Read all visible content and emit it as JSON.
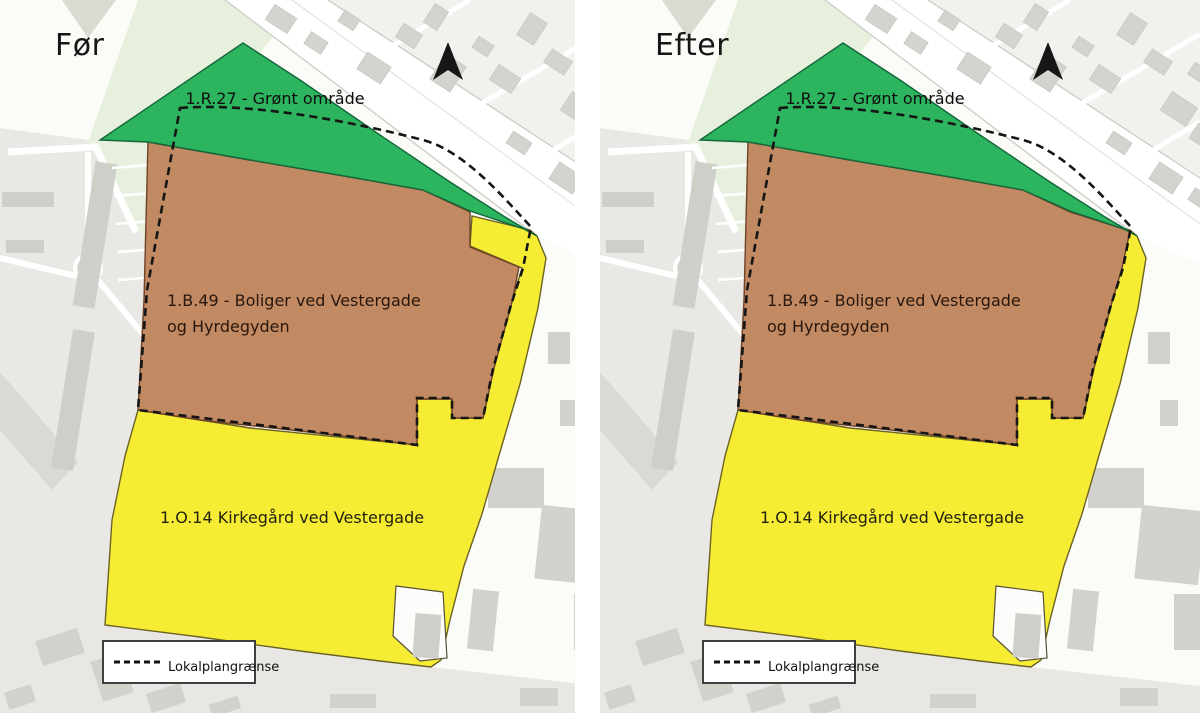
{
  "panels": {
    "before": {
      "title": "Før"
    },
    "after": {
      "title": "Efter"
    }
  },
  "legend": {
    "label": "Lokalplangrænse"
  },
  "zones": {
    "green": {
      "code": "1.R.27",
      "label": "1.R.27 - Grønt område",
      "color": "#2db45e"
    },
    "brown": {
      "code": "1.B.49",
      "label_line1": "1.B.49 - Boliger ved Vestergade",
      "label_line2": "og Hyrdegyden",
      "color": "#c18a62"
    },
    "yellow": {
      "code": "1.O.14",
      "label": "1.O.14 Kirkegård ved Vestergade",
      "color": "#f6ec33"
    }
  },
  "map_change": {
    "before_note": "yellow cemetery notch at NE corner of housing zone",
    "after_note": "housing zone extended to plan boundary at NE corner"
  },
  "geometry": {
    "base": [
      {
        "k": "polys",
        "f": "#fbfbf8",
        "name": "map-background",
        "items": [
          [
            [
              0,
              0
            ],
            [
              600,
              0
            ],
            [
              600,
              713
            ],
            [
              0,
              713
            ]
          ]
        ]
      },
      {
        "k": "polys",
        "f": "#f2f1ed",
        "name": "block-northeast",
        "items": [
          [
            [
              318,
              0
            ],
            [
              600,
              0
            ],
            [
              600,
              176
            ]
          ]
        ]
      },
      {
        "k": "polys",
        "f": "#e7f0dc",
        "name": "park-area",
        "items": [
          [
            [
              138,
              0
            ],
            [
              304,
              0
            ],
            [
              252,
              62
            ],
            [
              196,
              338
            ],
            [
              150,
              345
            ],
            [
              88,
              142
            ]
          ]
        ]
      },
      {
        "k": "polys",
        "f": "#d9dbd1",
        "name": "wooded-triangle",
        "items": [
          [
            [
              62,
              0
            ],
            [
              116,
              0
            ],
            [
              88,
              38
            ]
          ]
        ]
      },
      {
        "k": "polys",
        "f": "#eae8e4",
        "name": "residential-area-west",
        "items": [
          [
            [
              0,
              128
            ],
            [
              88,
              140
            ],
            [
              150,
              250
            ],
            [
              196,
              340
            ],
            [
              186,
              500
            ],
            [
              182,
              713
            ],
            [
              0,
              713
            ]
          ]
        ]
      },
      {
        "k": "polys",
        "f": "#dbd9d4",
        "name": "road-band-southwest",
        "items": [
          [
            [
              0,
              372
            ],
            [
              78,
              462
            ],
            [
              52,
              490
            ],
            [
              0,
              430
            ]
          ]
        ]
      },
      {
        "k": "polys",
        "f": "#e9e7e3",
        "name": "area-south",
        "items": [
          [
            [
              0,
              598
            ],
            [
              105,
              622
            ],
            [
              300,
              652
            ],
            [
              440,
              668
            ],
            [
              600,
              686
            ],
            [
              600,
              713
            ],
            [
              0,
              713
            ]
          ]
        ]
      },
      {
        "k": "polys",
        "f": "#ffffff",
        "name": "road-vestergade",
        "items": [
          [
            [
              225,
              0
            ],
            [
              328,
              0
            ],
            [
              600,
              178
            ],
            [
              600,
              264
            ],
            [
              537,
              236
            ]
          ]
        ]
      },
      {
        "k": "lines",
        "s": "#ccccc5",
        "sw": 1.3,
        "name": "road-edge",
        "items": [
          [
            328,
            0,
            600,
            178
          ],
          [
            225,
            0,
            537,
            236
          ]
        ]
      },
      {
        "k": "lines",
        "s": "#dedcd6",
        "sw": 1,
        "name": "road-centerline",
        "items": [
          [
            292,
            0,
            600,
            224
          ]
        ]
      },
      {
        "k": "lines",
        "s": "#ffffff",
        "sw": 5,
        "name": "side-street",
        "items": [
          [
            392,
            46,
            470,
            0
          ],
          [
            474,
            108,
            600,
            34
          ],
          [
            540,
            158,
            600,
            122
          ]
        ]
      },
      {
        "k": "rects",
        "f": "#d4d4cf",
        "s": "#c8c8c2",
        "sw": 0.8,
        "rot": 33,
        "name": "building",
        "items": [
          [
            268,
            10,
            26,
            18
          ],
          [
            306,
            36,
            20,
            14
          ],
          [
            340,
            14,
            18,
            13
          ],
          [
            360,
            58,
            28,
            20
          ],
          [
            398,
            28,
            22,
            16
          ],
          [
            428,
            6,
            16,
            22
          ],
          [
            436,
            58,
            24,
            30
          ],
          [
            474,
            40,
            18,
            13
          ],
          [
            492,
            70,
            26,
            18
          ],
          [
            522,
            16,
            20,
            26
          ],
          [
            546,
            54,
            24,
            16
          ],
          [
            564,
            98,
            30,
            22
          ],
          [
            590,
            66,
            18,
            14
          ],
          [
            592,
            128,
            24,
            18
          ],
          [
            508,
            136,
            22,
            14
          ],
          [
            552,
            168,
            28,
            20
          ],
          [
            590,
            192,
            20,
            14
          ]
        ]
      },
      {
        "k": "paths",
        "s": "#ffffff",
        "sw": 7,
        "name": "street-west",
        "items": [
          "M8,152 L96,147 L136,232"
        ]
      },
      {
        "k": "paths",
        "s": "#ffffff",
        "sw": 6,
        "name": "street-west",
        "items": [
          "M88,152 L88,256",
          "M76,276 L0,258",
          "M97,279 L146,338 L152,470 L150,600"
        ]
      },
      {
        "k": "circles",
        "f": "#dcdad5",
        "s": "#ffffff",
        "sw": 4,
        "name": "roundabout",
        "items": [
          [
            88,
            268,
            13
          ]
        ]
      },
      {
        "k": "rects",
        "f": "#cfcfca",
        "rot": 9,
        "name": "apartment-building",
        "items": [
          [
            84,
            162,
            22,
            146
          ],
          [
            62,
            330,
            22,
            140
          ]
        ]
      },
      {
        "k": "rects",
        "f": "#cfcfca",
        "name": "apartment-building",
        "items": [
          [
            2,
            192,
            52,
            15
          ],
          [
            6,
            240,
            38,
            13
          ]
        ]
      },
      {
        "k": "lines",
        "s": "#ffffff",
        "sw": 2.5,
        "name": "parking-grid",
        "items": [
          [
            112,
            168,
            150,
            165
          ],
          [
            114,
            196,
            152,
            193
          ],
          [
            116,
            224,
            154,
            221
          ],
          [
            118,
            252,
            156,
            249
          ],
          [
            118,
            280,
            156,
            277
          ]
        ]
      },
      {
        "k": "rects",
        "f": "#d2d2cd",
        "rot": -18,
        "name": "building",
        "items": [
          [
            38,
            634,
            44,
            26
          ],
          [
            96,
            656,
            32,
            42
          ],
          [
            6,
            688,
            28,
            18
          ],
          [
            148,
            688,
            36,
            20
          ],
          [
            210,
            700,
            30,
            13
          ]
        ]
      },
      {
        "k": "rects",
        "f": "#d2d2cd",
        "name": "building",
        "items": [
          [
            330,
            694,
            46,
            14
          ],
          [
            520,
            688,
            38,
            18
          ],
          [
            548,
            332,
            22,
            32
          ],
          [
            560,
            400,
            18,
            26
          ],
          [
            488,
            468,
            56,
            40
          ],
          [
            574,
            594,
            40,
            56
          ]
        ]
      },
      {
        "k": "rects",
        "f": "#d2d2cd",
        "rot": 6,
        "name": "building",
        "items": [
          [
            538,
            508,
            64,
            74
          ],
          [
            470,
            590,
            26,
            60
          ]
        ]
      }
    ],
    "zones_geo": {
      "yellow": {
        "k": "polys",
        "f": "$yellow",
        "s": "#6b6326",
        "sw": 1.4,
        "name": "zone-cemetery",
        "items": [
          [
            [
              537,
              236
            ],
            [
              546,
              258
            ],
            [
              538,
              308
            ],
            [
              520,
              384
            ],
            [
              500,
              452
            ],
            [
              482,
              514
            ],
            [
              464,
              566
            ],
            [
              450,
              620
            ],
            [
              441,
              660
            ],
            [
              431,
              667
            ],
            [
              380,
              661
            ],
            [
              300,
              651
            ],
            [
              200,
              637
            ],
            [
              105,
              625
            ],
            [
              112,
              520
            ],
            [
              125,
              456
            ],
            [
              138,
              410
            ],
            [
              250,
              428
            ],
            [
              417,
              445
            ],
            [
              417,
              399
            ],
            [
              452,
              399
            ],
            [
              452,
              418
            ],
            [
              483,
              418
            ],
            [
              494,
              368
            ],
            [
              512,
              302
            ],
            [
              522,
              268
            ],
            [
              470,
              246
            ],
            [
              472,
              216
            ],
            [
              530,
              230
            ]
          ]
        ]
      },
      "brown_before": {
        "k": "polys",
        "f": "$brown",
        "s": "#6e4226",
        "sw": 1.4,
        "name": "zone-housing",
        "items": [
          [
            [
              148,
              142
            ],
            [
              250,
              160
            ],
            [
              350,
              177
            ],
            [
              423,
              190
            ],
            [
              470,
              212
            ],
            [
              470,
              247
            ],
            [
              519,
              267
            ],
            [
              512,
              302
            ],
            [
              494,
              368
            ],
            [
              483,
              418
            ],
            [
              452,
              418
            ],
            [
              452,
              399
            ],
            [
              417,
              399
            ],
            [
              417,
              445
            ],
            [
              300,
              431
            ],
            [
              200,
              420
            ],
            [
              138,
              410
            ],
            [
              144,
              300
            ]
          ]
        ]
      },
      "brown_after": {
        "k": "polys",
        "f": "$brown",
        "s": "#6e4226",
        "sw": 1.4,
        "name": "zone-housing",
        "items": [
          [
            [
              148,
              142
            ],
            [
              250,
              160
            ],
            [
              350,
              177
            ],
            [
              423,
              190
            ],
            [
              470,
              212
            ],
            [
              530,
              231
            ],
            [
              522,
              268
            ],
            [
              512,
              302
            ],
            [
              494,
              368
            ],
            [
              483,
              418
            ],
            [
              452,
              418
            ],
            [
              452,
              399
            ],
            [
              417,
              399
            ],
            [
              417,
              445
            ],
            [
              300,
              431
            ],
            [
              200,
              420
            ],
            [
              138,
              410
            ],
            [
              144,
              300
            ]
          ]
        ]
      },
      "green": {
        "k": "polys",
        "f": "$green",
        "s": "#14663a",
        "sw": 1.4,
        "name": "zone-green-area",
        "items": [
          [
            [
              243,
              43
            ],
            [
              300,
              80
            ],
            [
              380,
              135
            ],
            [
              450,
              182
            ],
            [
              505,
              217
            ],
            [
              537,
              236
            ],
            [
              524,
              229
            ],
            [
              470,
              211
            ],
            [
              423,
              190
            ],
            [
              350,
              177
            ],
            [
              250,
              160
            ],
            [
              148,
              142
            ],
            [
              100,
              140
            ]
          ]
        ]
      }
    },
    "post": [
      {
        "k": "polys",
        "f": "#fcfcfa",
        "s": "#55503a",
        "sw": 1.2,
        "name": "cemetery-cutout",
        "items": [
          [
            [
              396,
              586
            ],
            [
              443,
              592
            ],
            [
              447,
              658
            ],
            [
              420,
              661
            ],
            [
              393,
              636
            ]
          ]
        ]
      },
      {
        "k": "rects",
        "f": "#cfcfca",
        "rot": 4,
        "name": "building",
        "items": [
          [
            414,
            614,
            26,
            44
          ]
        ]
      },
      {
        "k": "paths",
        "s": "#151515",
        "sw": 2.6,
        "dash": "8 5",
        "name": "lokalplan-boundary",
        "items": [
          "M180,108 C240,103 330,116 423,140 C465,151 505,199 531,227 L523,268 L511,305 L493,369 L483,418 L452,418 L452,398 L417,398 L417,445 L300,430 L138,410 L147,290 Z"
        ]
      },
      {
        "k": "paths",
        "f": "#161616",
        "name": "north-arrow-icon",
        "items": [
          "M448,42 L463,80 L448,70 L433,80 Z"
        ]
      },
      {
        "k": "rects",
        "f": "#ffffff",
        "s": "#3f3f3f",
        "sw": 2,
        "name": "legend-box",
        "items": [
          [
            103,
            641,
            152,
            42
          ]
        ]
      },
      {
        "k": "lines",
        "s": "#111111",
        "sw": 3,
        "dash": "6 4",
        "name": "legend-dash-sample",
        "items": [
          [
            114,
            662,
            160,
            662
          ]
        ]
      }
    ],
    "labels": [
      {
        "x": 275,
        "y": 104,
        "anchor": "middle",
        "size": 16,
        "fill": "#0d0d0d",
        "bind": "zones.green.label",
        "name": "zone-label-green"
      },
      {
        "x": 167,
        "y": 306,
        "anchor": "start",
        "size": 16,
        "fill": "#29160d",
        "bind": "zones.brown.label_line1",
        "name": "zone-label-housing-line1"
      },
      {
        "x": 167,
        "y": 332,
        "anchor": "start",
        "size": 16,
        "fill": "#29160d",
        "bind": "zones.brown.label_line2",
        "name": "zone-label-housing-line2"
      },
      {
        "x": 160,
        "y": 523,
        "anchor": "start",
        "size": 16,
        "fill": "#22220f",
        "bind": "zones.yellow.label",
        "name": "zone-label-cemetery"
      },
      {
        "x": 168,
        "y": 671,
        "anchor": "start",
        "size": 13,
        "fill": "#111111",
        "bind": "legend.label",
        "name": "legend-label"
      }
    ]
  }
}
